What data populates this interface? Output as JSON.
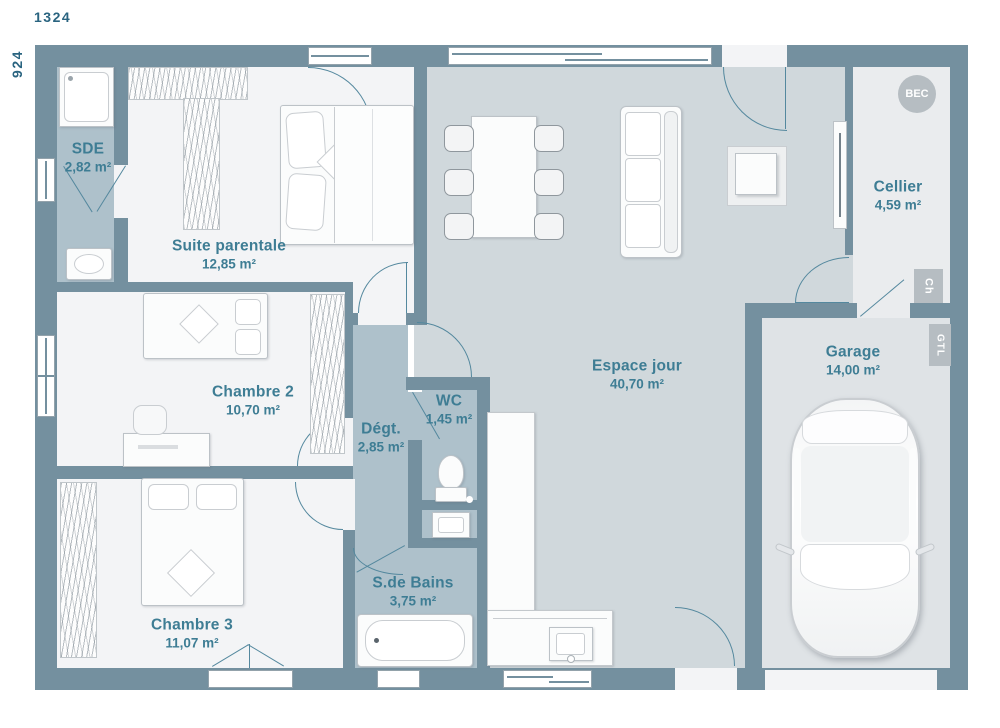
{
  "plan": {
    "title": "house-floor-plan",
    "dimensions": {
      "width_label": "1324",
      "height_label": "924"
    },
    "rooms": [
      {
        "id": "sde",
        "name": "SDE",
        "area": "2,82 m²"
      },
      {
        "id": "suite",
        "name": "Suite parentale",
        "area": "12,85 m²"
      },
      {
        "id": "chambre2",
        "name": "Chambre 2",
        "area": "10,70 m²"
      },
      {
        "id": "degt",
        "name": "Dégt.",
        "area": "2,85 m²"
      },
      {
        "id": "wc",
        "name": "WC",
        "area": "1,45 m²"
      },
      {
        "id": "sdb",
        "name": "S.de Bains",
        "area": "3,75 m²"
      },
      {
        "id": "chambre3",
        "name": "Chambre 3",
        "area": "11,07 m²"
      },
      {
        "id": "espace",
        "name": "Espace jour",
        "area": "40,70 m²"
      },
      {
        "id": "cellier",
        "name": "Cellier",
        "area": "4,59 m²"
      },
      {
        "id": "garage",
        "name": "Garage",
        "area": "14,00 m²"
      }
    ],
    "annotations": {
      "bec": "BEC",
      "ch": "Ch",
      "gtl": "GTL"
    },
    "colors": {
      "wall": "#74909f",
      "floor_room": "#f3f4f6",
      "floor_living": "#d0d8dc",
      "floor_wet": "#aec1cb",
      "floor_garage": "#dfe3e6",
      "floor_cellier": "#eaecee",
      "door_arc": "#54889e",
      "label_text": "#3e7d94",
      "dimension_text": "#2a6480",
      "tag_bg": "#b6bdc2"
    }
  }
}
